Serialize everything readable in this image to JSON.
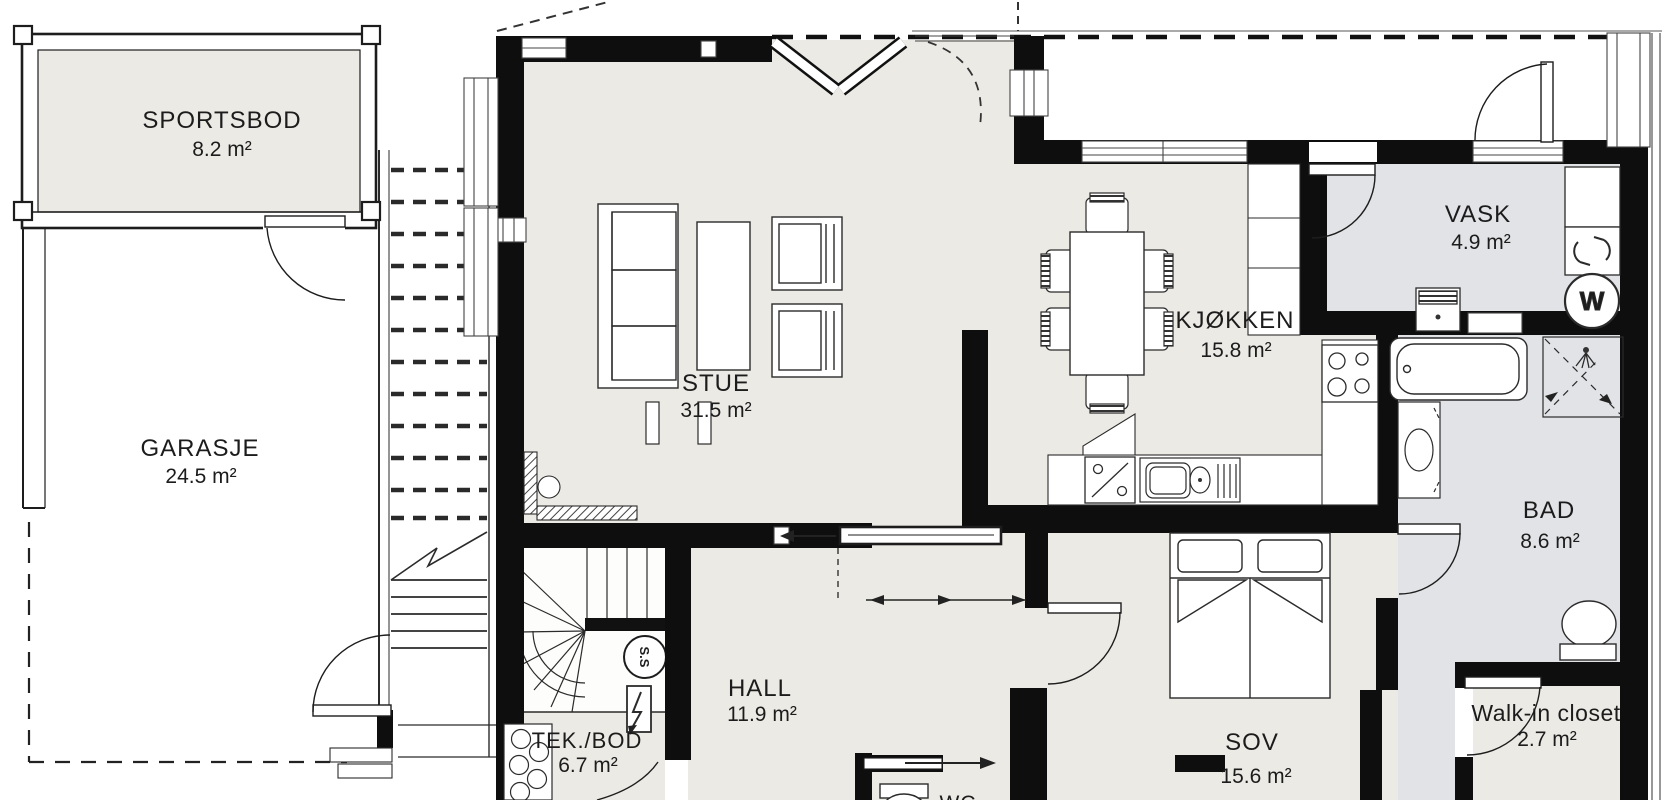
{
  "plan_title": "First floor plan",
  "rooms": [
    {
      "id": "sportsbod",
      "name": "SPORTSBOD",
      "area": "8.2 m²"
    },
    {
      "id": "garasje",
      "name": "GARASJE",
      "area": "24.5 m²"
    },
    {
      "id": "stue",
      "name": "STUE",
      "area": "31.5 m²"
    },
    {
      "id": "kjokken",
      "name": "KJØKKEN",
      "area": "15.8 m²"
    },
    {
      "id": "vask",
      "name": "VASK",
      "area": "4.9 m²"
    },
    {
      "id": "bad",
      "name": "BAD",
      "area": "8.6 m²"
    },
    {
      "id": "hall",
      "name": "HALL",
      "area": "11.9 m²"
    },
    {
      "id": "tek-bod",
      "name": "TEK./BOD",
      "area": "6.7 m²"
    },
    {
      "id": "sov",
      "name": "SOV",
      "area": "15.6 m²"
    },
    {
      "id": "walk-in-closet",
      "name": "Walk-in closet",
      "area": "2.7 m²"
    },
    {
      "id": "wc",
      "name": "WC",
      "area": ""
    }
  ],
  "symbols": {
    "stair_marker": "S.S",
    "washing_machine": "W"
  },
  "colors": {
    "floor": "#ECEAE5",
    "wet_floor": "#E2E3E6",
    "wall": "#0E0E0E",
    "line": "#2B2B2B"
  }
}
